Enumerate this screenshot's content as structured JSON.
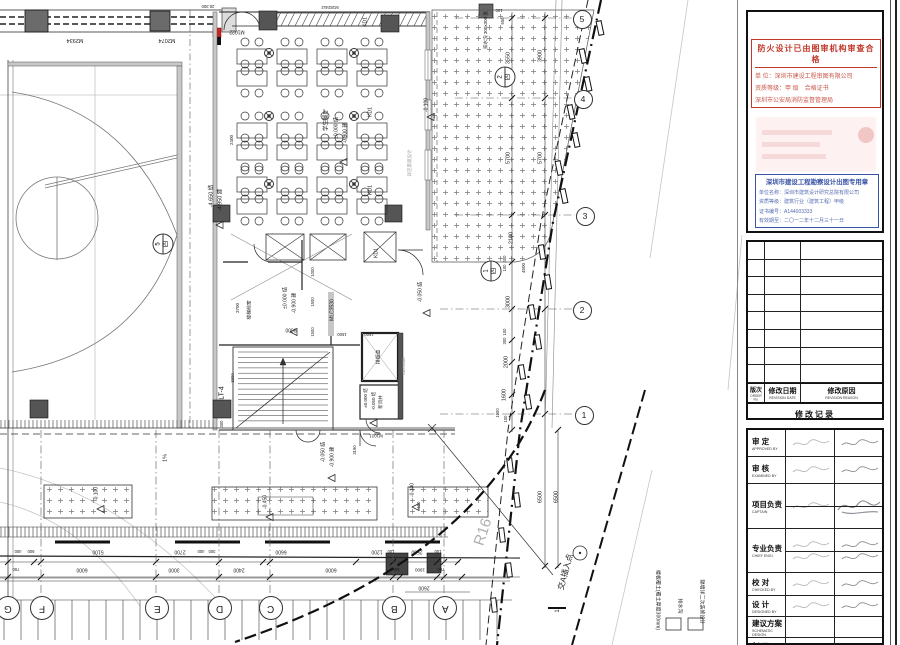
{
  "plan": {
    "annotations": [
      {
        "t": "M2934",
        "x": 75,
        "y": 39,
        "r": 180,
        "s": 5.5
      },
      {
        "t": "M2074",
        "x": 167,
        "y": 39,
        "r": 180,
        "s": 5.5
      },
      {
        "t": "M1022",
        "x": 237,
        "y": 31,
        "r": 180,
        "s": 5
      },
      {
        "t": "20.300",
        "x": 208,
        "y": 6,
        "r": 180,
        "s": 4.2
      },
      {
        "t": "M1824x2",
        "x": 330,
        "y": 7,
        "r": 180,
        "s": 4.2
      },
      {
        "t": "排水沟 300x300 宽",
        "x": 486,
        "y": 30,
        "r": -90,
        "s": 4.5
      },
      {
        "t": "100",
        "x": 499,
        "y": 10,
        "r": 180,
        "s": 4.2
      },
      {
        "t": "550",
        "x": 503,
        "y": 21,
        "r": -90,
        "s": 4.2
      },
      {
        "t": "3550",
        "x": 509,
        "y": 58,
        "r": -90,
        "s": 5.5
      },
      {
        "t": "3900",
        "x": 541,
        "y": 56,
        "r": -90,
        "s": 5.5
      },
      {
        "t": "5700",
        "x": 509,
        "y": 158,
        "r": -90,
        "s": 5.5
      },
      {
        "t": "5700",
        "x": 541,
        "y": 158,
        "r": -90,
        "s": 5.5
      },
      {
        "t": "2100",
        "x": 512,
        "y": 238,
        "r": -90,
        "s": 5.5
      },
      {
        "t": "400",
        "x": 505,
        "y": 259,
        "r": -90,
        "s": 4.2
      },
      {
        "t": "100",
        "x": 505,
        "y": 268,
        "r": -90,
        "s": 4.2
      },
      {
        "t": "4500",
        "x": 524,
        "y": 268,
        "r": -90,
        "s": 4.5
      },
      {
        "t": "3000",
        "x": 509,
        "y": 302,
        "r": -90,
        "s": 5.5
      },
      {
        "t": "100",
        "x": 505,
        "y": 332,
        "r": -90,
        "s": 4.2
      },
      {
        "t": "300",
        "x": 505,
        "y": 341,
        "r": -90,
        "s": 4.2
      },
      {
        "t": "2000",
        "x": 507,
        "y": 362,
        "r": -90,
        "s": 5.5
      },
      {
        "t": "1600",
        "x": 505,
        "y": 395,
        "r": -90,
        "s": 5.5
      },
      {
        "t": "1900",
        "x": 498,
        "y": 413,
        "r": -90,
        "s": 4.2
      },
      {
        "t": "100",
        "x": 506,
        "y": 419,
        "r": -90,
        "s": 4.2
      },
      {
        "t": "6500",
        "x": 541,
        "y": 497,
        "r": -90,
        "s": 5.5
      },
      {
        "t": "6500",
        "x": 557,
        "y": 497,
        "r": -90,
        "s": 5.5
      },
      {
        "t": "-0.100",
        "x": 427,
        "y": 105,
        "r": -90,
        "s": 5
      },
      {
        "t": "详见景观设计",
        "x": 410,
        "y": 163,
        "r": -90,
        "s": 4.5,
        "c": "#999"
      },
      {
        "t": "KD1",
        "x": 366,
        "y": 22,
        "r": -90,
        "s": 5
      },
      {
        "t": "KD1",
        "x": 371,
        "y": 112,
        "r": -90,
        "s": 5
      },
      {
        "t": "KD1",
        "x": 371,
        "y": 190,
        "r": -90,
        "s": 5
      },
      {
        "t": "KD1",
        "x": 377,
        "y": 253,
        "r": -90,
        "s": 5
      },
      {
        "t": "学生餐厅",
        "x": 327,
        "y": 120,
        "r": -90,
        "s": 5.5
      },
      {
        "t": "±0.000 结",
        "x": 337,
        "y": 128,
        "r": -90,
        "s": 5
      },
      {
        "t": "-0.900 建",
        "x": 346,
        "y": 133,
        "r": -90,
        "s": 5
      },
      {
        "t": "-4.650 结",
        "x": 212,
        "y": 196,
        "r": -90,
        "s": 5.5
      },
      {
        "t": "-4.950 建",
        "x": 221,
        "y": 200,
        "r": -90,
        "s": 5.5
      },
      {
        "t": "2400",
        "x": 232,
        "y": 140,
        "r": -90,
        "s": 4.5
      },
      {
        "t": "楼梯前室",
        "x": 251,
        "y": 310,
        "r": -90,
        "s": 4.8
      },
      {
        "t": "±0.000 结",
        "x": 286,
        "y": 298,
        "r": -90,
        "s": 5
      },
      {
        "t": "-0.900 建",
        "x": 295,
        "y": 303,
        "r": -90,
        "s": 5
      },
      {
        "t": "MLC3530",
        "x": 333,
        "y": 310,
        "r": -90,
        "s": 5
      },
      {
        "t": "3700",
        "x": 238,
        "y": 308,
        "r": -90,
        "s": 4.5
      },
      {
        "t": "9600",
        "x": 291,
        "y": 329,
        "r": 180,
        "s": 5
      },
      {
        "t": "1000",
        "x": 313,
        "y": 272,
        "r": -90,
        "s": 4.2
      },
      {
        "t": "1500",
        "x": 313,
        "y": 302,
        "r": -90,
        "s": 4.2
      },
      {
        "t": "1500",
        "x": 313,
        "y": 332,
        "r": -90,
        "s": 4.2
      },
      {
        "t": "1500",
        "x": 342,
        "y": 334,
        "r": 180,
        "s": 4.2
      },
      {
        "t": "1500",
        "x": 369,
        "y": 334,
        "r": 180,
        "s": 4.2
      },
      {
        "t": "LT-4",
        "x": 222,
        "y": 393,
        "r": -90,
        "s": 7
      },
      {
        "t": "3300",
        "x": 233,
        "y": 378,
        "r": -90,
        "s": 4.2
      },
      {
        "t": "排烟道",
        "x": 380,
        "y": 357,
        "r": -90,
        "s": 4.8
      },
      {
        "t": "LBY2208",
        "x": 404,
        "y": 366,
        "r": -90,
        "s": 4.2,
        "c": "#888"
      },
      {
        "t": "新风井",
        "x": 381,
        "y": 402,
        "r": -90,
        "s": 4.5
      },
      {
        "t": "±0.000 结",
        "x": 366,
        "y": 398,
        "r": -90,
        "s": 4.5
      },
      {
        "t": "-0.050 结",
        "x": 374,
        "y": 401,
        "r": -90,
        "s": 4.5
      },
      {
        "t": "-0.050 结",
        "x": 421,
        "y": 292,
        "r": -90,
        "s": 5
      },
      {
        "t": "M1021",
        "x": 376,
        "y": 435,
        "r": 180,
        "s": 4.5
      },
      {
        "t": "300",
        "x": 222,
        "y": 424,
        "r": -90,
        "s": 4.2
      },
      {
        "t": "-0.050 结",
        "x": 324,
        "y": 452,
        "r": -90,
        "s": 5
      },
      {
        "t": "-0.900 建",
        "x": 333,
        "y": 457,
        "r": -90,
        "s": 5
      },
      {
        "t": "3190",
        "x": 355,
        "y": 450,
        "r": -90,
        "s": 4.2
      },
      {
        "t": "1%",
        "x": 166,
        "y": 458,
        "r": -90,
        "s": 5.5
      },
      {
        "t": "-0.100",
        "x": 97,
        "y": 494,
        "r": -90,
        "s": 5
      },
      {
        "t": "-0.450",
        "x": 266,
        "y": 502,
        "r": -90,
        "s": 5
      },
      {
        "t": "-0.100",
        "x": 413,
        "y": 490,
        "r": -90,
        "s": 5
      },
      {
        "t": "600",
        "x": 419,
        "y": 505,
        "r": -90,
        "s": 4.2
      },
      {
        "t": "R16",
        "x": 483,
        "y": 532,
        "r": -72,
        "s": 15,
        "c": "#b0b0b0"
      },
      {
        "t": "交A插入点",
        "x": 566,
        "y": 572,
        "r": -75,
        "s": 8
      },
      {
        "t": "1",
        "x": 558,
        "y": 611,
        "r": -90,
        "s": 6
      },
      {
        "t": "400",
        "x": 18,
        "y": 551,
        "r": 180,
        "s": 4.2
      },
      {
        "t": "900",
        "x": 31,
        "y": 551,
        "r": 180,
        "s": 4.2
      },
      {
        "t": "5100",
        "x": 98,
        "y": 551,
        "r": 180,
        "s": 5
      },
      {
        "t": "2700",
        "x": 180,
        "y": 551,
        "r": 180,
        "s": 5
      },
      {
        "t": "400",
        "x": 201,
        "y": 551,
        "r": 180,
        "s": 4.2
      },
      {
        "t": "300",
        "x": 212,
        "y": 551,
        "r": 180,
        "s": 4.2
      },
      {
        "t": "6600",
        "x": 281,
        "y": 551,
        "r": 180,
        "s": 5
      },
      {
        "t": "1200",
        "x": 377,
        "y": 551,
        "r": 180,
        "s": 5
      },
      {
        "t": "100",
        "x": 391,
        "y": 551,
        "r": 180,
        "s": 4.2
      },
      {
        "t": "2500",
        "x": 417,
        "y": 551,
        "r": 180,
        "s": 5
      },
      {
        "t": "100",
        "x": 438,
        "y": 551,
        "r": 180,
        "s": 4.2
      },
      {
        "t": "700",
        "x": 16,
        "y": 569,
        "r": 180,
        "s": 4.2
      },
      {
        "t": "6000",
        "x": 82,
        "y": 569,
        "r": 180,
        "s": 5
      },
      {
        "t": "3000",
        "x": 174,
        "y": 569,
        "r": 180,
        "s": 5
      },
      {
        "t": "2400",
        "x": 239,
        "y": 569,
        "r": 180,
        "s": 5
      },
      {
        "t": "6000",
        "x": 331,
        "y": 569,
        "r": 180,
        "s": 5
      },
      {
        "t": "500",
        "x": 396,
        "y": 569,
        "r": 180,
        "s": 4.2
      },
      {
        "t": "1900",
        "x": 420,
        "y": 569,
        "r": 180,
        "s": 4.5
      },
      {
        "t": "700",
        "x": 441,
        "y": 569,
        "r": 180,
        "s": 4.2
      },
      {
        "t": "2600",
        "x": 424,
        "y": 587,
        "r": 180,
        "s": 5
      },
      {
        "t": "楼板覆土(覆土厚度300mm)",
        "x": 657,
        "y": 600,
        "r": 90,
        "s": 5
      },
      {
        "t": "排水沟",
        "x": 679,
        "y": 606,
        "r": 90,
        "s": 5
      },
      {
        "t": "隔墙详二次装修设计",
        "x": 701,
        "y": 602,
        "r": 90,
        "s": 5
      }
    ],
    "grid_bubbles_right": [
      {
        "label": "5",
        "x": 581,
        "y": 18
      },
      {
        "label": "4",
        "x": 582,
        "y": 98
      },
      {
        "label": "3",
        "x": 584,
        "y": 215
      },
      {
        "label": "2",
        "x": 581,
        "y": 309
      },
      {
        "label": "1",
        "x": 583,
        "y": 414
      }
    ],
    "grid_bubbles_bottom": [
      {
        "label": "G",
        "x": 7,
        "y": 607
      },
      {
        "label": "F",
        "x": 41,
        "y": 607
      },
      {
        "label": "E",
        "x": 156,
        "y": 607
      },
      {
        "label": "D",
        "x": 219,
        "y": 607
      },
      {
        "label": "C",
        "x": 270,
        "y": 607
      },
      {
        "label": "B",
        "x": 393,
        "y": 607
      },
      {
        "label": "A",
        "x": 444,
        "y": 607
      }
    ],
    "detail_markers": [
      {
        "num": "2",
        "sheet": "四",
        "x": 505,
        "y": 77
      },
      {
        "num": "1",
        "sheet": "四",
        "x": 491,
        "y": 271
      },
      {
        "num": "5",
        "sheet": "四",
        "x": 163,
        "y": 244
      }
    ]
  },
  "titleblock": {
    "fire_stamp": {
      "title": "防火设计已由图审机构审查合格",
      "lines": [
        "单 位：深圳市建设工程审图有限公司",
        "资质等级：甲 级　合格证书",
        "深圳市公安局消防监督管理局"
      ]
    },
    "blue_stamp": {
      "title": "深圳市建设工程勘察设计出图专用章",
      "lines": [
        "单位名称：深圳市建筑设计研究总院有限公司",
        "资质等级：建筑行业（建筑工程）甲级",
        "证书编号：A144003333",
        "有效期至：二〇一二年十二月三十一日"
      ]
    },
    "revision": {
      "empty_rows": 8,
      "columns": [
        {
          "cn": "版次",
          "en": "ORDER No."
        },
        {
          "cn": "修改日期",
          "en": "REVISION DATE"
        },
        {
          "cn": "修改原因",
          "en": "REVISION REASON"
        }
      ],
      "footer_cn": "修改记录",
      "footer_en": "REVISION REMARK"
    },
    "signatures": {
      "rows": [
        {
          "cn": "审 定",
          "en": "APPROVED BY",
          "h": 27,
          "name": true,
          "sig": true
        },
        {
          "cn": "审 核",
          "en": "EXAMINED BY",
          "h": 27,
          "name": true,
          "sig": true
        },
        {
          "cn": "项目负责",
          "en": "CAPTAIN",
          "h": 45,
          "name": true,
          "sig_big": true,
          "dual": true
        },
        {
          "cn": "专业负责",
          "en": "CHIEF ENGI.",
          "h": 44,
          "name": true,
          "sig": true,
          "dual": true,
          "name2": true,
          "sig2": true
        },
        {
          "cn": "校 对",
          "en": "CHECKED BY",
          "h": 23,
          "name": true,
          "sig": true
        },
        {
          "cn": "设 计",
          "en": "DESIGNED BY",
          "h": 21,
          "name": true,
          "sig": true
        },
        {
          "cn": "建议方案",
          "en": "SCHEMATIC DESIGN",
          "h": 21
        },
        {
          "cn": "制 图",
          "en": "",
          "h": 18
        }
      ]
    }
  }
}
